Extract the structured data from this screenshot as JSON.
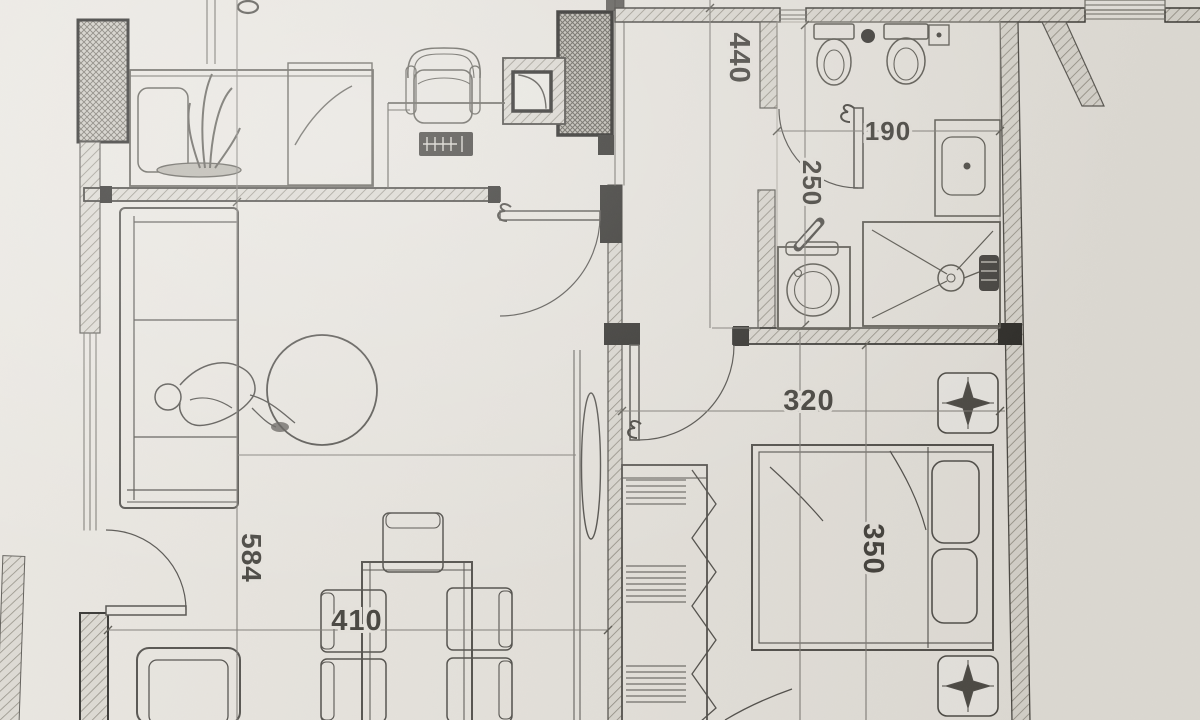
{
  "drawing": {
    "type": "apartment-floor-plan-photo",
    "dimensions_cm": {
      "hallway_depth": "440",
      "bathroom_width": "190",
      "bathroom_depth": "250",
      "bedroom_width": "320",
      "bedroom_depth": "350",
      "living_room_depth": "584",
      "living_room_width": "410"
    },
    "colors": {
      "paper": "#e9e6e0",
      "ink": "#4b4945",
      "wall_fill": "#dcd9d2",
      "wall_dark": "#242320",
      "hatch": "#8d897e"
    }
  }
}
